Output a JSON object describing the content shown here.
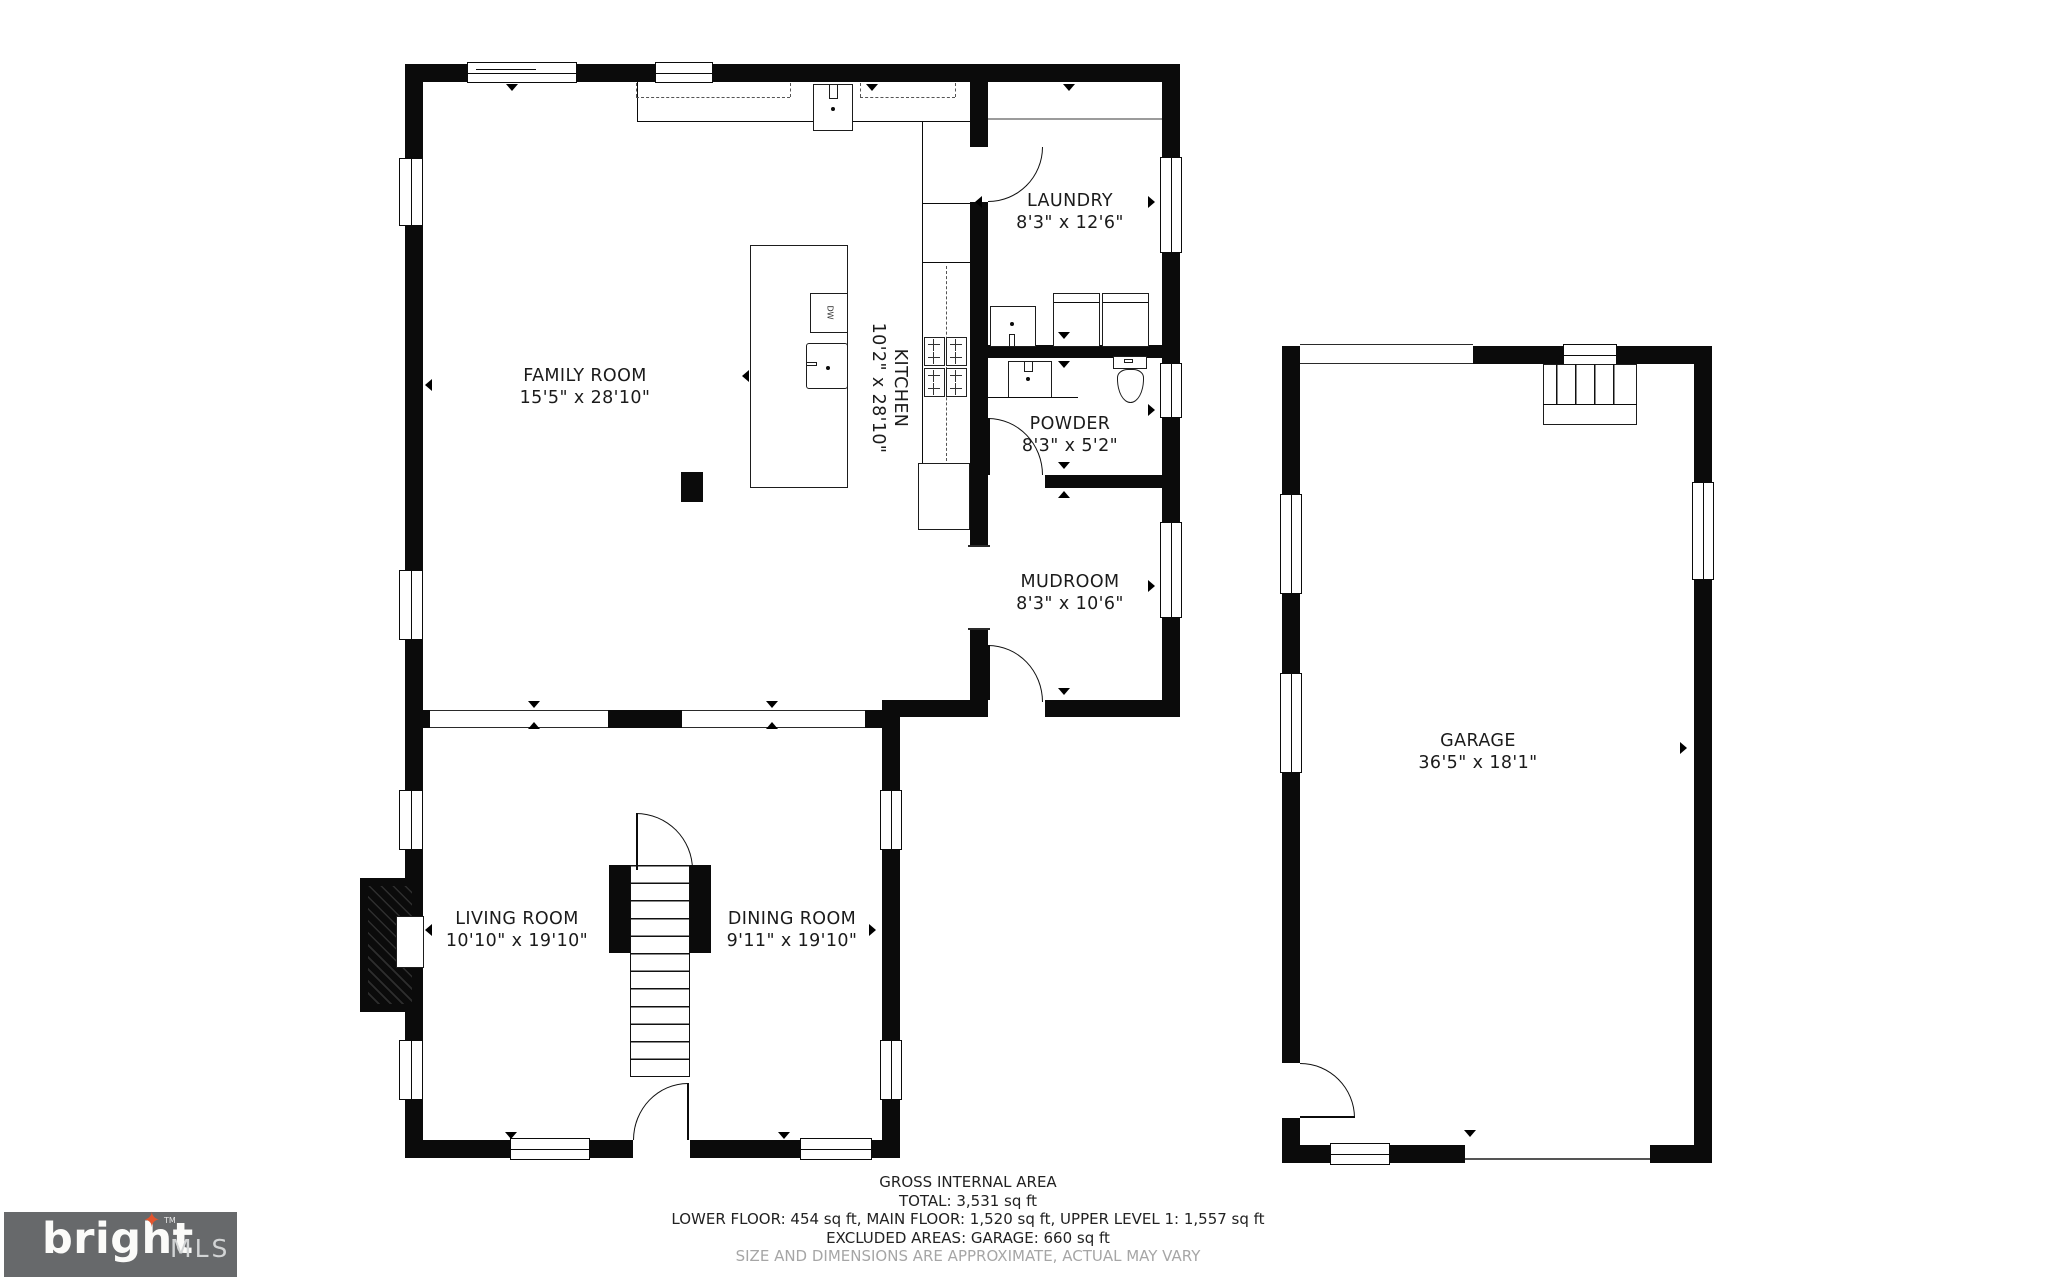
{
  "plan": {
    "rooms": {
      "family_room": {
        "name": "FAMILY ROOM",
        "dims": "15'5\" x 28'10\""
      },
      "kitchen": {
        "name": "KITCHEN",
        "dims": "10'2\" x 28'10\""
      },
      "laundry": {
        "name": "LAUNDRY",
        "dims": "8'3\" x 12'6\""
      },
      "powder": {
        "name": "POWDER",
        "dims": "8'3\" x 5'2\""
      },
      "mudroom": {
        "name": "MUDROOM",
        "dims": "8'3\" x 10'6\""
      },
      "living_room": {
        "name": "LIVING ROOM",
        "dims": "10'10\" x 19'10\""
      },
      "dining_room": {
        "name": "DINING ROOM",
        "dims": "9'11\" x 19'10\""
      },
      "garage": {
        "name": "GARAGE",
        "dims": "36'5\" x 18'1\""
      }
    },
    "fixtures": {
      "dishwasher": "DW"
    }
  },
  "footer": {
    "title": "GROSS INTERNAL AREA",
    "total": "TOTAL: 3,531 sq ft",
    "floors": "LOWER FLOOR: 454 sq ft, MAIN FLOOR: 1,520 sq ft, UPPER LEVEL 1: 1,557 sq ft",
    "excluded": "EXCLUDED AREAS: GARAGE: 660 sq ft",
    "disclaimer": "SIZE AND DIMENSIONS ARE APPROXIMATE, ACTUAL MAY VARY"
  },
  "logo": {
    "brand": "bright",
    "mls": "MLS",
    "tm": "TM",
    "star_icon": "✦"
  },
  "colors": {
    "walls": "#0b0b0b",
    "logo_bg": "#67696b",
    "logo_star": "#e2552e",
    "disclaimer_text": "#a6a6a6"
  }
}
